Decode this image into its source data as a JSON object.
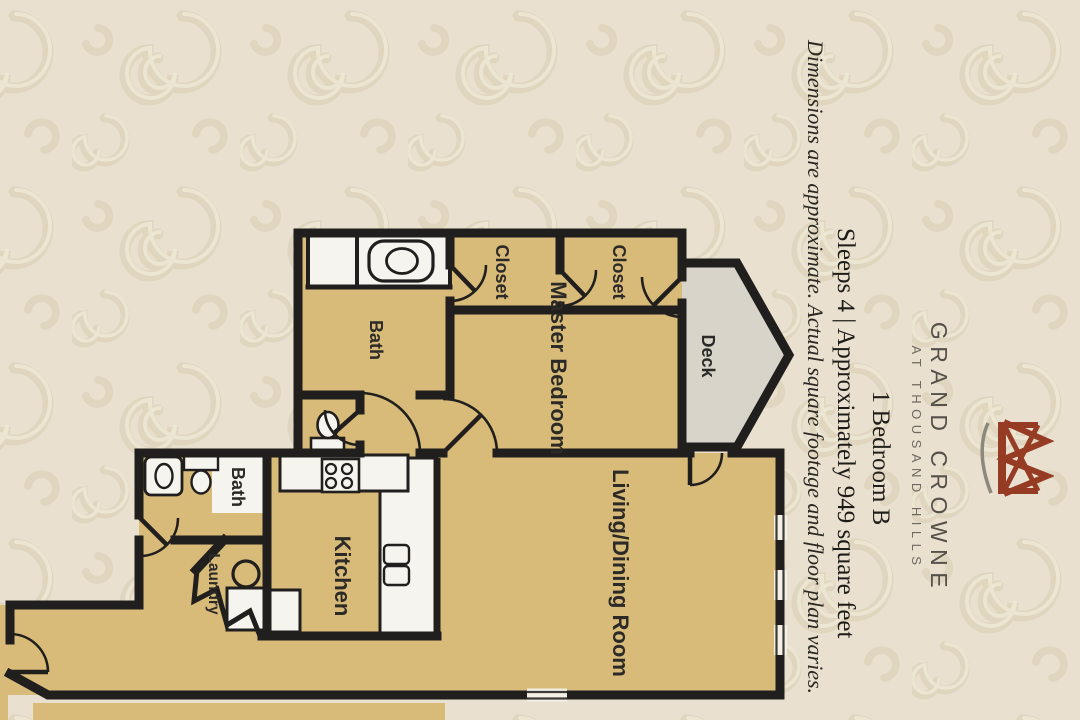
{
  "header": {
    "brand": "GRAND CROWNE",
    "brand_subtitle": "AT THOUSAND HILLS",
    "unit_name": "1 Bedroom B",
    "specs_line": "Sleeps 4 | Approximately 949 square feet",
    "disclaimer": "Dimensions are approximate.  Actual square footage and floor plan varies."
  },
  "floor_plan": {
    "rooms": {
      "master_bedroom": "Master Bedroom",
      "living_dining": "Living/Dining Room",
      "kitchen": "Kitchen",
      "master_bath": "Bath",
      "guest_bath": "Bath",
      "closet_upper": "Closet",
      "closet_lower": "Closet",
      "laundry": "Laundry",
      "deck": "Deck"
    }
  },
  "colors": {
    "page_background": "#e9e0cf",
    "pattern": "#d8ccb2",
    "floor_tan": "#d8ba79",
    "deck_gray": "#d8d4ca",
    "wall_black": "#201f1d",
    "fixture_white": "#f6f4ee",
    "logo_maroon": "#963b24"
  }
}
